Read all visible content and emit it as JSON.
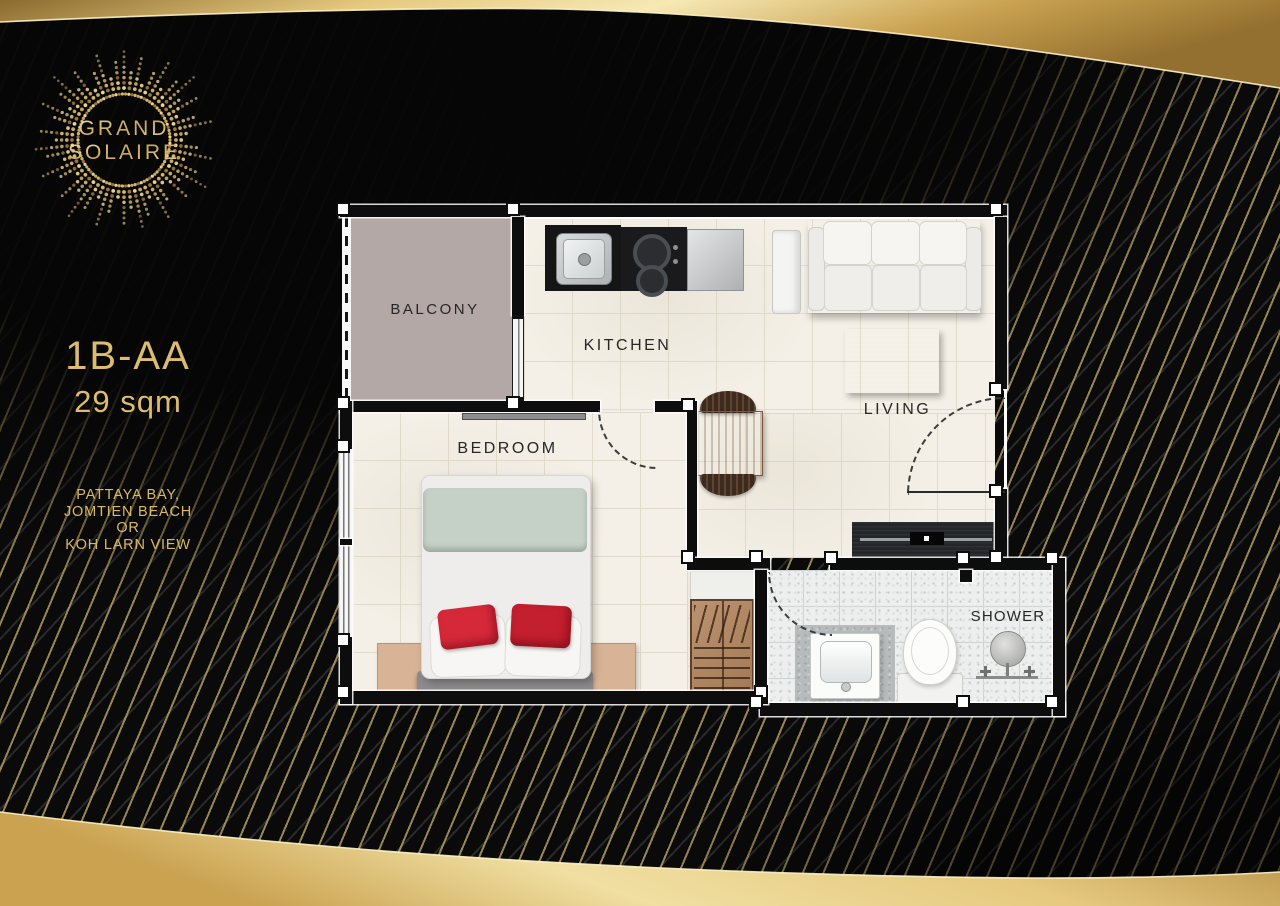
{
  "brand": {
    "name_line1": "GRAND",
    "name_line2": "SOLAIRE"
  },
  "unit": {
    "code": "1B-AA",
    "area": "29 sqm"
  },
  "views": {
    "line1": "PATTAYA BAY,",
    "line2": "JOMTIEN BEACH",
    "line3": "OR",
    "line4": "KOH LARN VIEW"
  },
  "rooms": {
    "balcony": "BALCONY",
    "kitchen": "KITCHEN",
    "living": "LIVING",
    "bedroom": "BEDROOM",
    "shower": "SHOWER"
  },
  "colors": {
    "gold_text": "#dcbd70",
    "band_gold": "#e6c97e",
    "stripe_gold": "#c9ae66",
    "wall_black": "#0d0d0d",
    "cushion_red": "#cf2733",
    "duvet_sage": "#c5d0c7",
    "balcony_tile": "#b3a8a6",
    "marble_cream": "#f4f0e7"
  }
}
